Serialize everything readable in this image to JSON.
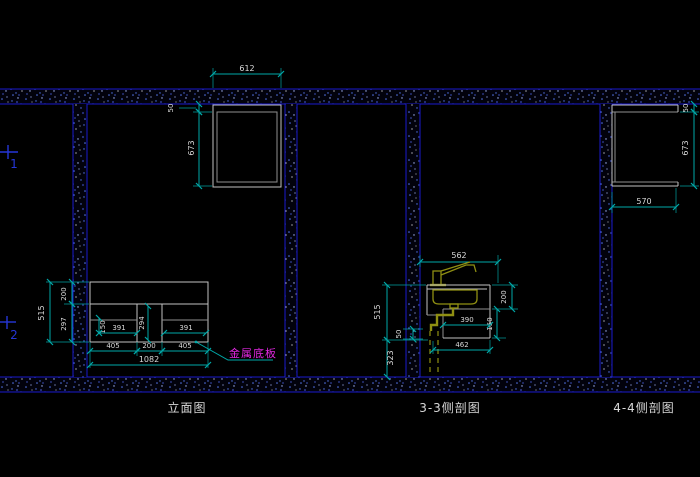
{
  "titles": {
    "elevation": "立面图",
    "section_33": "3-3侧剖图",
    "section_44": "4-4侧剖图"
  },
  "annotations": {
    "metal_base_plate": "金属底板"
  },
  "grid_markers": {
    "marker_1": "1",
    "marker_2": "2"
  },
  "dimensions": {
    "elevation": {
      "top_cabinet_width": "612",
      "ceiling_gap": "50",
      "top_cabinet_height": "673",
      "base_total_height": "515",
      "base_upper_height": "200",
      "base_lower_height": "297",
      "drawer_height": "150",
      "drawer_width_left": "391",
      "middle_opening_height": "294",
      "drawer_width_right": "391",
      "bottom_width_left": "405",
      "bottom_width_middle": "200",
      "bottom_width_right": "405",
      "bottom_width_total": "1082"
    },
    "section_33": {
      "counter_depth": "562",
      "counter_total_height": "515",
      "toe_gap": "50",
      "under_height": "323",
      "apron_height": "200",
      "lower_panel_height": "150",
      "inner_depth": "390",
      "base_depth": "462"
    },
    "section_44": {
      "ceiling_gap": "50",
      "cabinet_height": "673",
      "cabinet_depth": "570"
    }
  },
  "colors": {
    "background": "#000000",
    "wall_border_blue": "#1a1acd",
    "speckle_blue": "#5577ee",
    "dimension_cyan": "#00a9a9",
    "dimension_text": "#d8d8d8",
    "object_gray": "#c2c2c2",
    "fixture_olive": "#8f8f12",
    "annotation_magenta": "#e228e2",
    "grid_marker_blue": "#2536d8"
  }
}
